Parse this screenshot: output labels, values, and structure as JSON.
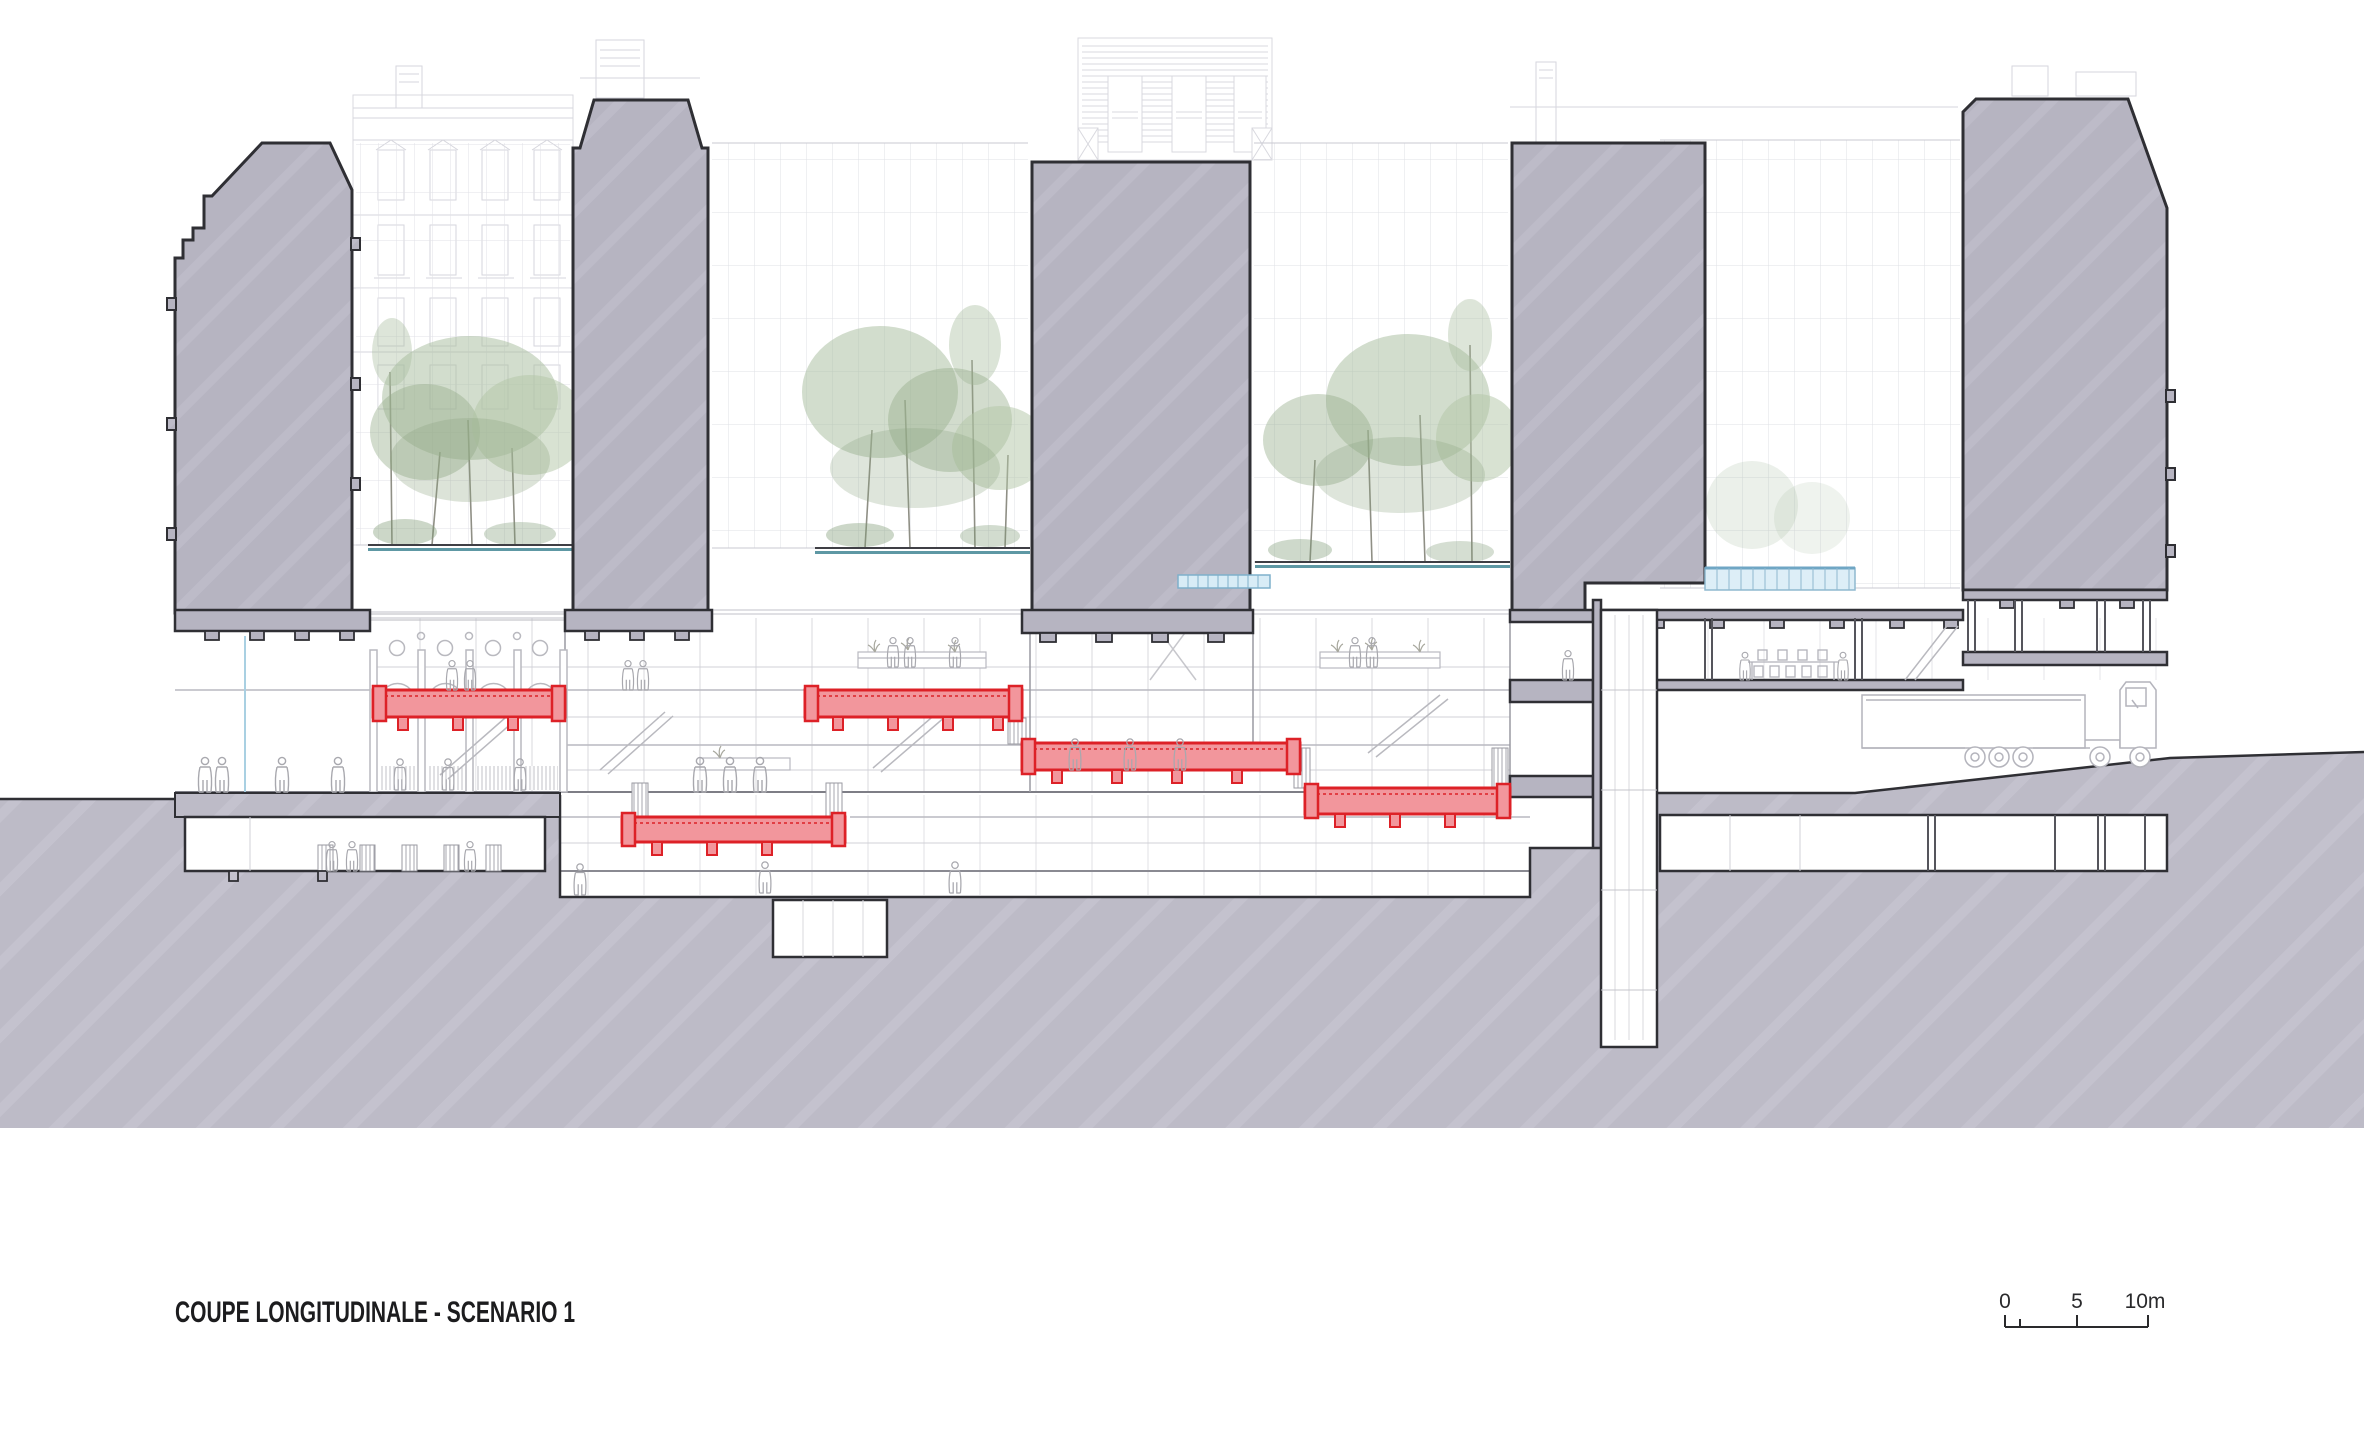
{
  "title": {
    "label": "COUPE LONGITUDINALE - SCENARIO 1"
  },
  "scale_bar": {
    "zero": "0",
    "five": "5",
    "ten": "10m"
  },
  "drawing": {
    "type": "architectural longitudinal section",
    "scenario_number": "1",
    "highlighted_slabs_count": 5,
    "building_masses_count": 5,
    "tree_clusters_count": 3,
    "colors": {
      "mass_gray": "#b6b4c1",
      "ground_gray": "#bdbbc7",
      "section_outline": "#2f2f34",
      "red_slab_fill": "#f2969c",
      "red_slab_stroke": "#dd2127",
      "planter_teal": "#5e98a4",
      "glass_blue": "#7fb0cb",
      "faint_line": "#dadae1"
    }
  }
}
